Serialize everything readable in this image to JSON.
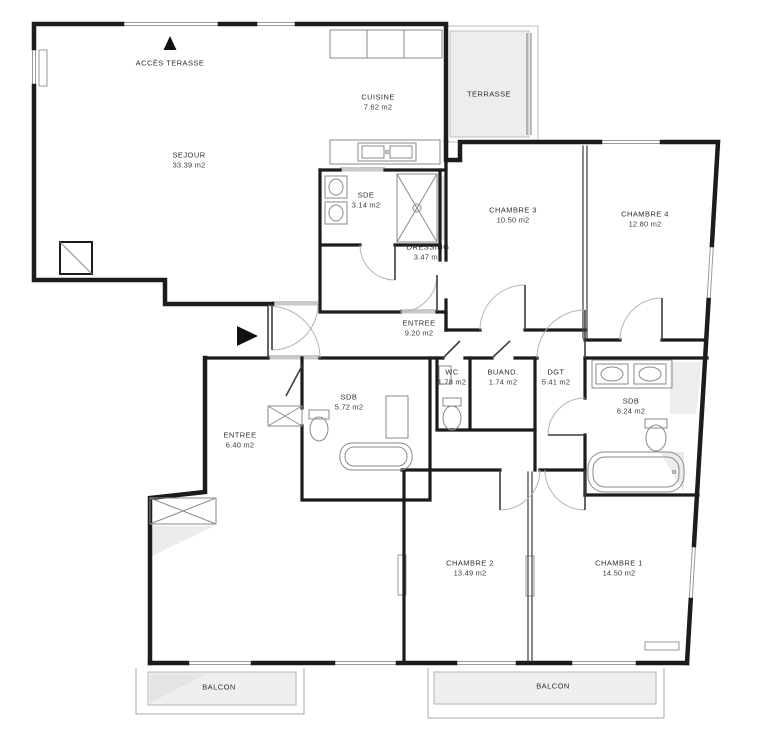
{
  "plan": {
    "title": "Plan d'appartement",
    "access_label": "ACCÈS TERASSE",
    "colors": {
      "wall": "#1c1c1c",
      "outdoor_fill": "#ededed",
      "fixture_line": "#8a8a8a",
      "window_line": "#999999"
    },
    "rooms": [
      {
        "id": "sejour",
        "name": "SEJOUR",
        "area": "33.39 m2",
        "x": 189,
        "y": 160
      },
      {
        "id": "cuisine",
        "name": "CUISINE",
        "area": "7.62 m2",
        "x": 378,
        "y": 102
      },
      {
        "id": "terrasse",
        "name": "TERRASSE",
        "area": "",
        "x": 489,
        "y": 94
      },
      {
        "id": "sde",
        "name": "SDE",
        "area": "3.14 m2",
        "x": 366,
        "y": 200
      },
      {
        "id": "dressing",
        "name": "DRESSING",
        "area": "3.47 m2",
        "x": 428,
        "y": 252
      },
      {
        "id": "chambre3",
        "name": "CHAMBRE 3",
        "area": "10.50 m2",
        "x": 513,
        "y": 215
      },
      {
        "id": "chambre4",
        "name": "CHAMBRE 4",
        "area": "12.80 m2",
        "x": 645,
        "y": 219
      },
      {
        "id": "entree1",
        "name": "ENTREE",
        "area": "9.20 m2",
        "x": 419,
        "y": 328
      },
      {
        "id": "wc",
        "name": "WC",
        "area": "1.78 m2",
        "x": 452,
        "y": 377
      },
      {
        "id": "buand",
        "name": "BUAND.",
        "area": "1.74 m2",
        "x": 503,
        "y": 377
      },
      {
        "id": "dgt",
        "name": "DGT",
        "area": "5.41 m2",
        "x": 556,
        "y": 377
      },
      {
        "id": "sdb1",
        "name": "SDB",
        "area": "5.72 m2",
        "x": 349,
        "y": 402
      },
      {
        "id": "sdb2",
        "name": "SDB",
        "area": "6.24 m2",
        "x": 631,
        "y": 406
      },
      {
        "id": "entree2",
        "name": "ENTREE",
        "area": "6.40 m2",
        "x": 240,
        "y": 440
      },
      {
        "id": "chambre2",
        "name": "CHAMBRE 2",
        "area": "13.49 m2",
        "x": 470,
        "y": 568
      },
      {
        "id": "chambre1",
        "name": "CHAMBRE 1",
        "area": "14.50 m2",
        "x": 619,
        "y": 568
      },
      {
        "id": "balcon1",
        "name": "BALCON",
        "area": "",
        "x": 219,
        "y": 687
      },
      {
        "id": "balcon2",
        "name": "BALCON",
        "area": "",
        "x": 553,
        "y": 686
      }
    ]
  }
}
